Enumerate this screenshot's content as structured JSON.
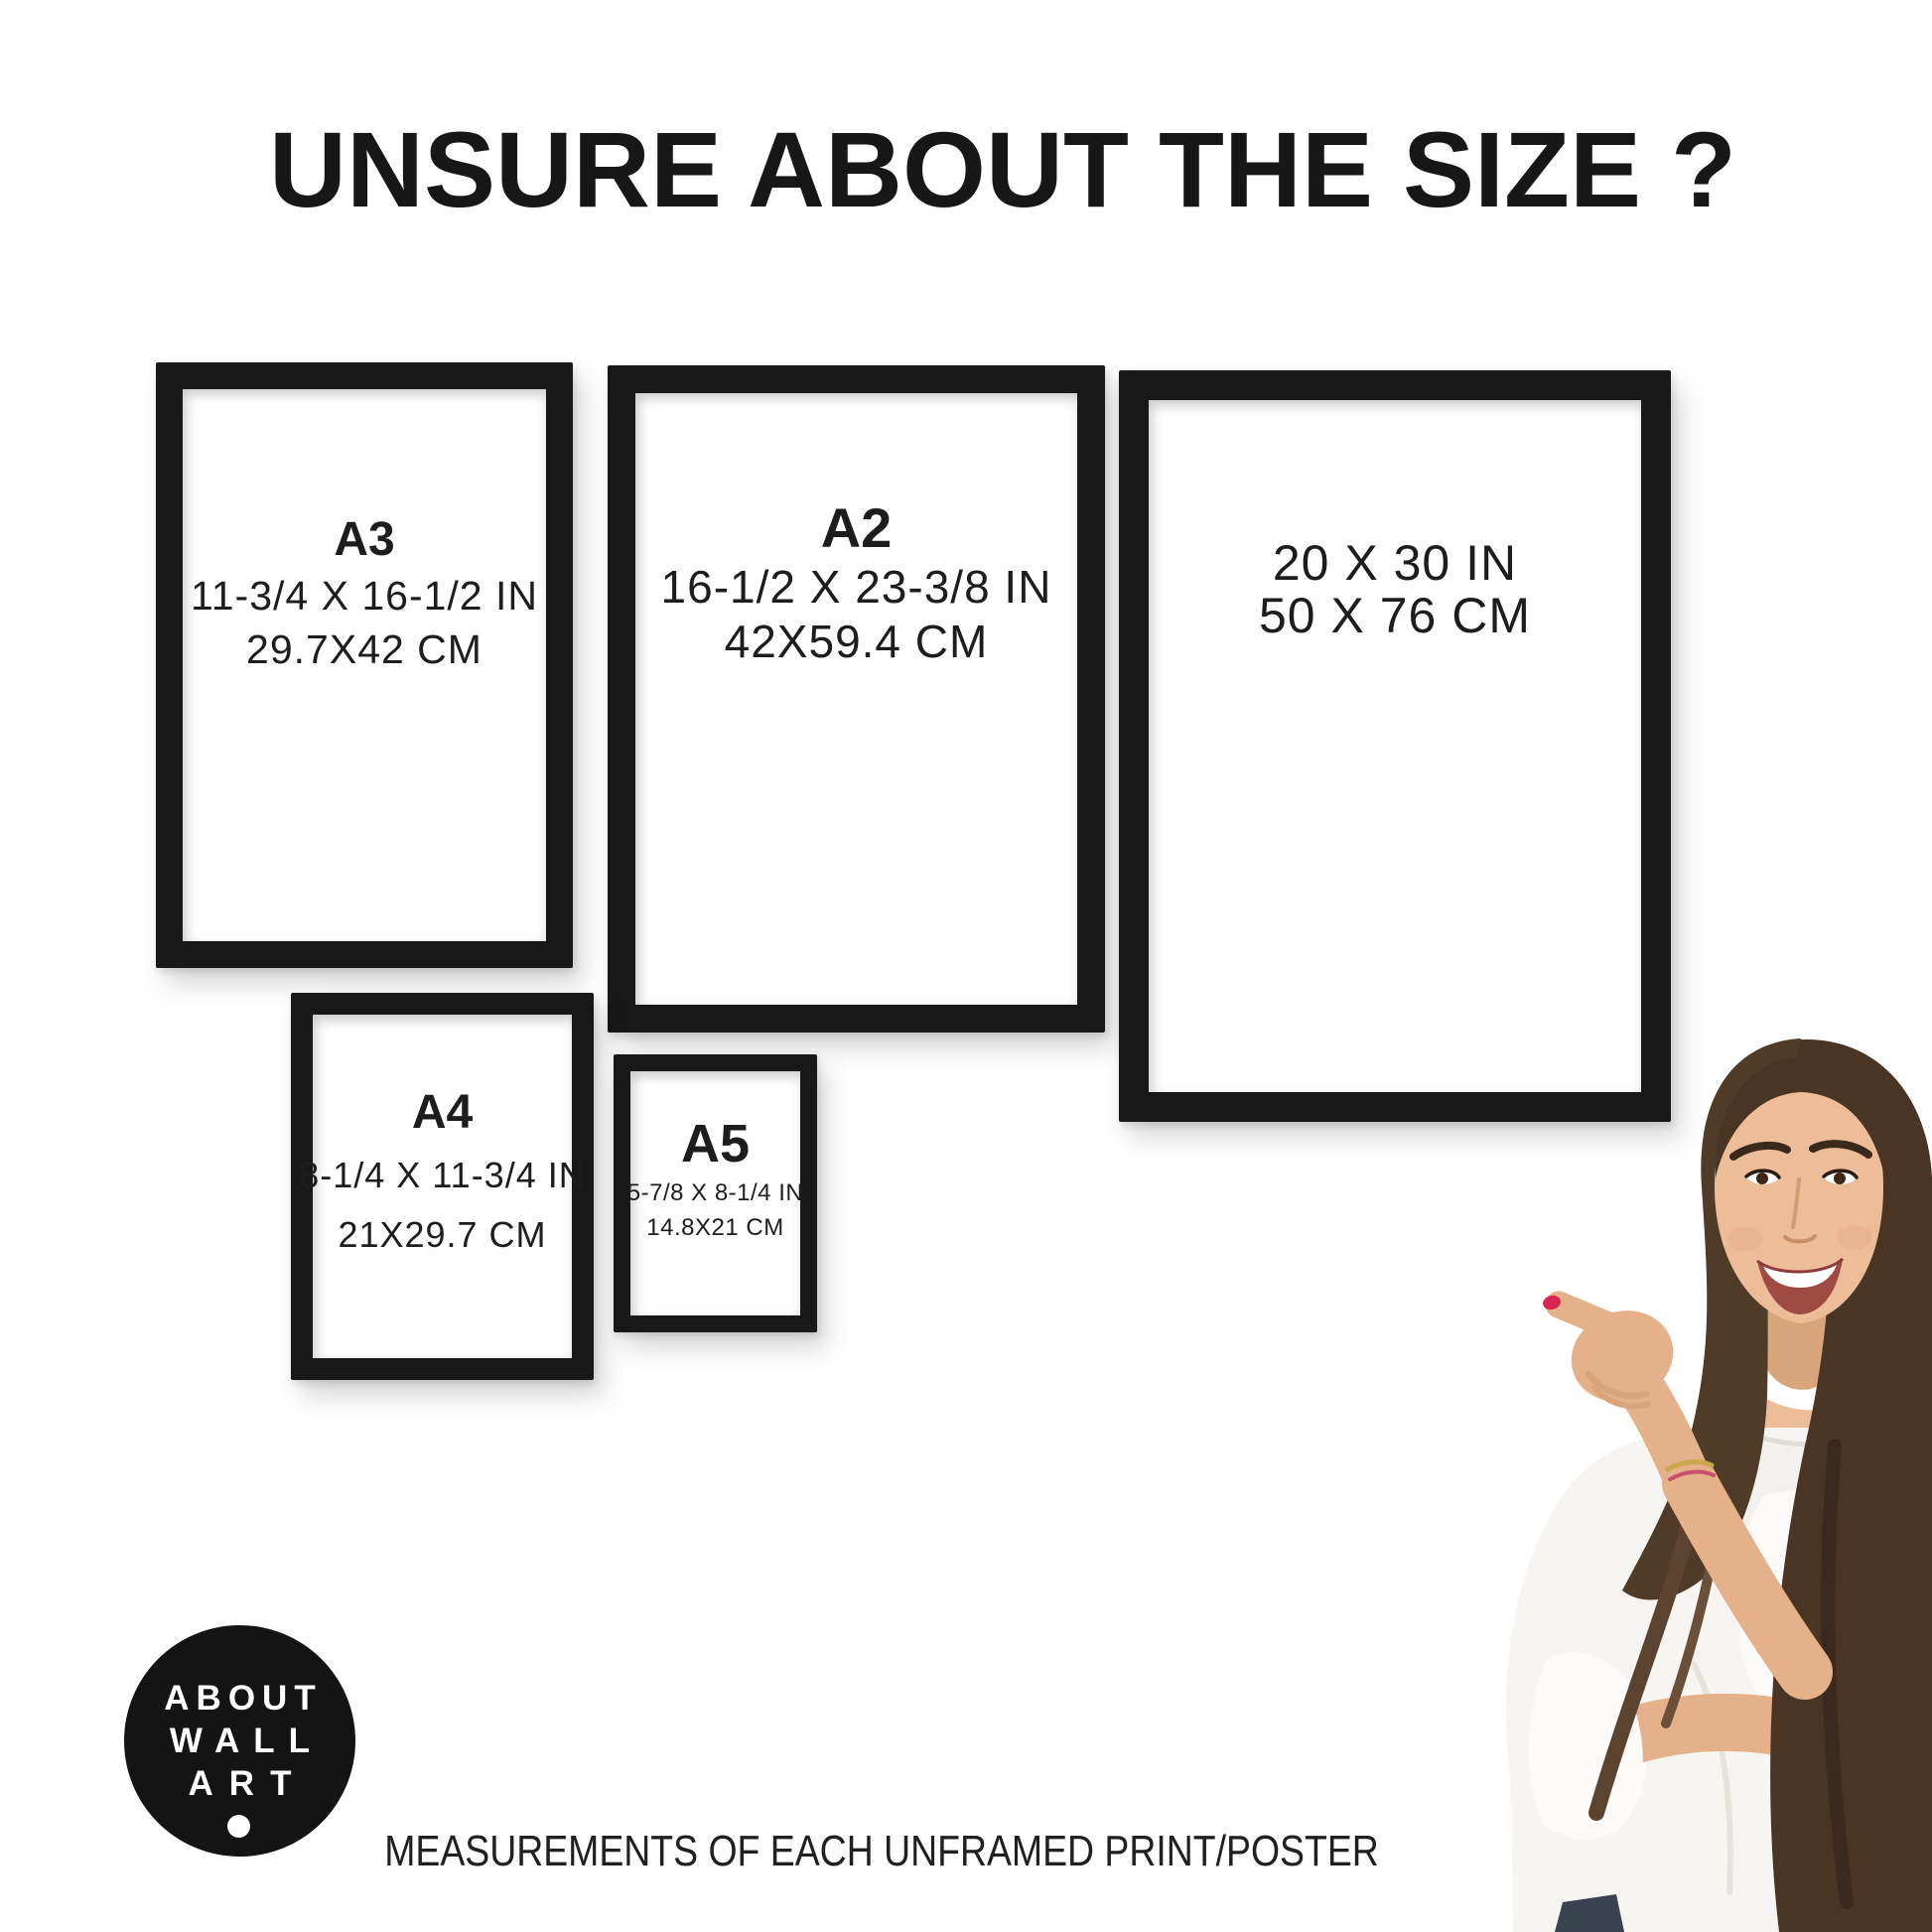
{
  "title": "UNSURE ABOUT THE SIZE ?",
  "frames": [
    {
      "id": "a3",
      "label": "A3",
      "inches": "11-3/4 X 16-1/2 IN",
      "cm": "29.7X42 CM"
    },
    {
      "id": "a2",
      "label": "A2",
      "inches": "16-1/2 X 23-3/8 IN",
      "cm": "42X59.4 CM"
    },
    {
      "id": "poster",
      "label": "",
      "inches": "20 X 30 IN",
      "cm": "50 X 76 CM"
    },
    {
      "id": "a4",
      "label": "A4",
      "inches": "8-1/4 X 11-3/4 IN",
      "cm": "21X29.7 CM"
    },
    {
      "id": "a5",
      "label": "A5",
      "inches": "5-7/8 X 8-1/4 IN",
      "cm": "14.8X21 CM"
    }
  ],
  "logo": {
    "line1": "ABOUT",
    "line2": "WALL",
    "line3": "ART"
  },
  "caption": "MEASUREMENTS OF EACH UNFRAMED PRINT/POSTER",
  "colors": {
    "frame_black": "#181818",
    "text_black": "#1c1c1c",
    "background": "#ffffff",
    "nail_red": "#d6234f",
    "hair_brown": "#4a3424",
    "skin": "#ecbd98",
    "blouse_white": "#f7f5f2"
  }
}
